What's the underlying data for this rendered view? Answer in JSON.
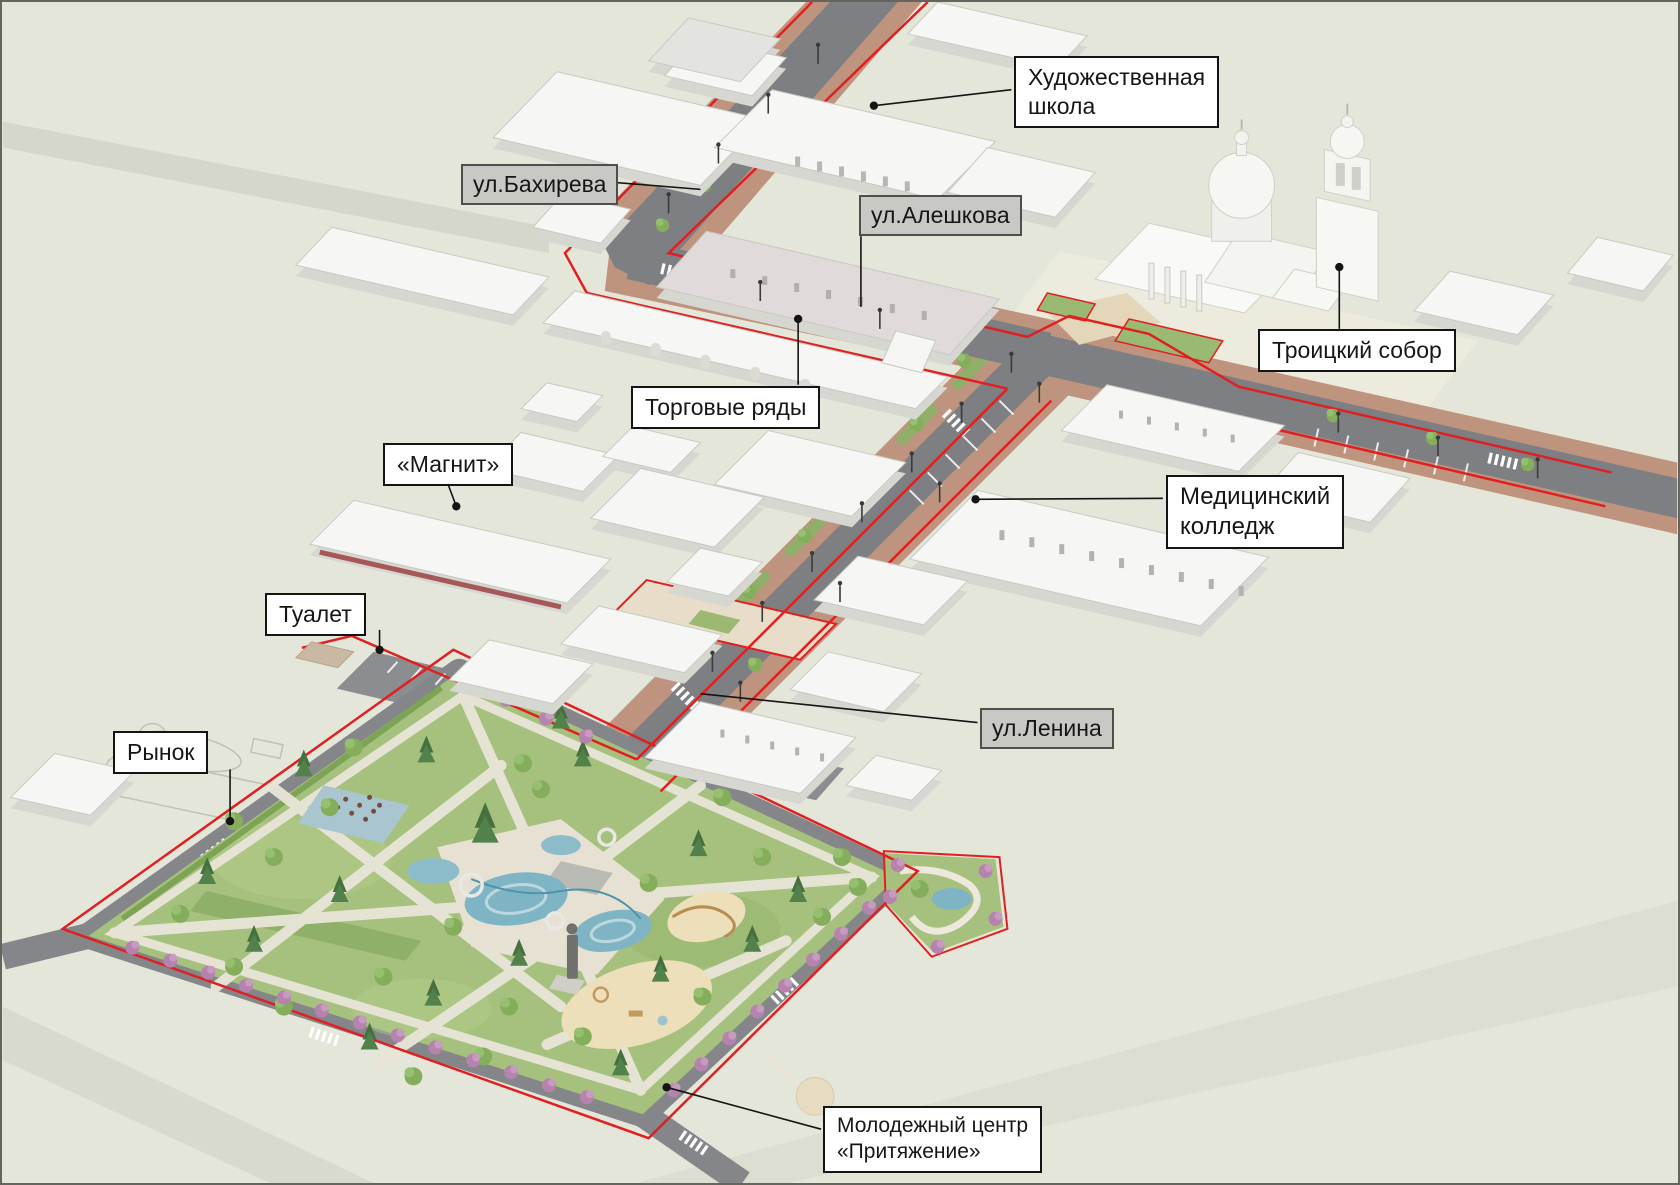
{
  "colors": {
    "background": "#e5e6da",
    "boundary_red": "#e02020",
    "asphalt": "#7d7f82",
    "brick_sidewalk": "#bf947f",
    "park_green": "#a6c17d",
    "water_blue": "#7fb4c4",
    "label_building_bg": "#ffffff",
    "label_street_bg": "#c8c8c5"
  },
  "labels": {
    "art_school": {
      "line1": "Художественная",
      "line2": "школа"
    },
    "bakhireva": {
      "text": "ул.Бахирева"
    },
    "aleshkova": {
      "text": "ул.Алешкова"
    },
    "trinity_cathedral": {
      "text": "Троицкий собор"
    },
    "trading_rows": {
      "text": "Торговые ряды"
    },
    "magnit": {
      "text": "«Магнит»"
    },
    "medical_college": {
      "line1": "Медицинский",
      "line2": "колледж"
    },
    "toilet": {
      "text": "Туалет"
    },
    "market": {
      "text": "Рынок"
    },
    "lenina": {
      "text": "ул.Ленина"
    },
    "youth_center": {
      "line1": "Молодежный центр",
      "line2": "«Притяжение»"
    }
  }
}
